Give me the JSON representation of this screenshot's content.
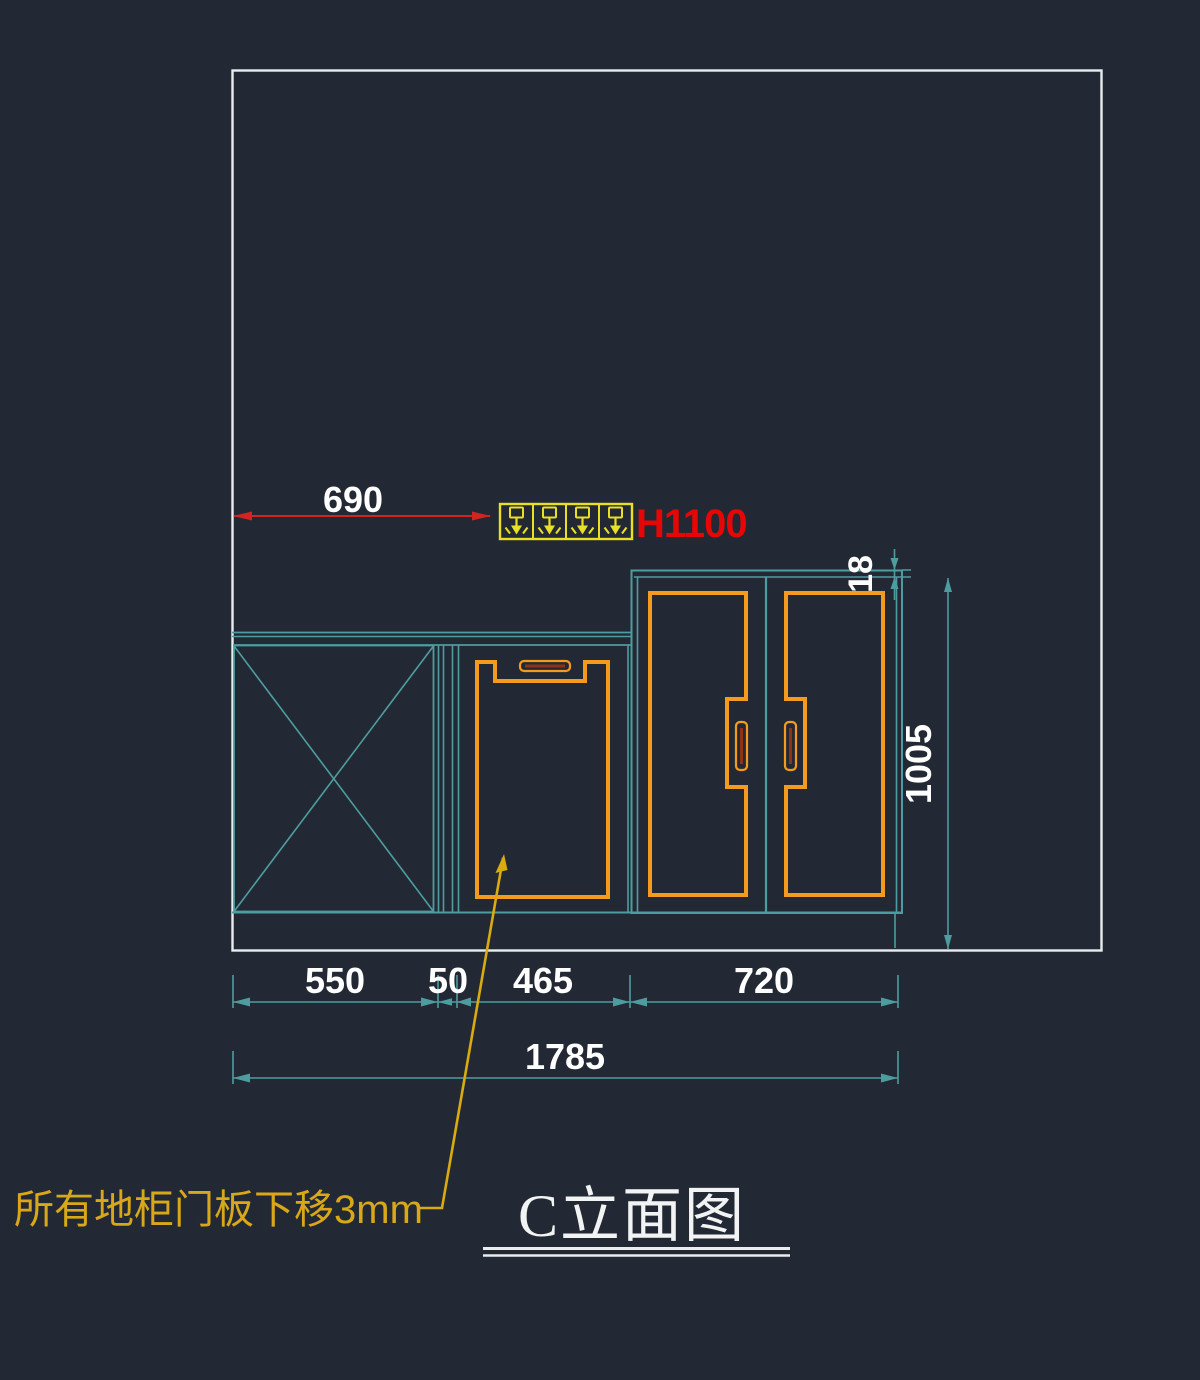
{
  "drawing": {
    "title": "C立面图",
    "annotation_note": "所有地柜门板下移3mm",
    "socket_height_label": "H1100",
    "socket_count": 4,
    "dimensions": {
      "socket_offset": "690",
      "top_panel_thickness": "18",
      "tall_cabinet_height": "1005",
      "bottom_segments": [
        "550",
        "50",
        "465",
        "720"
      ],
      "total_width": "1785"
    },
    "colors": {
      "background": "#232934",
      "cabinet_outline_teal": "#4d9da0",
      "door_orange": "#f49b1d",
      "socket_yellow": "#e9df25",
      "dimension_red": "#d22420",
      "label_red": "#e60606",
      "note_gold": "#d9a818",
      "border_white": "#e9eded",
      "dim_text_white": "#ffffff"
    }
  }
}
